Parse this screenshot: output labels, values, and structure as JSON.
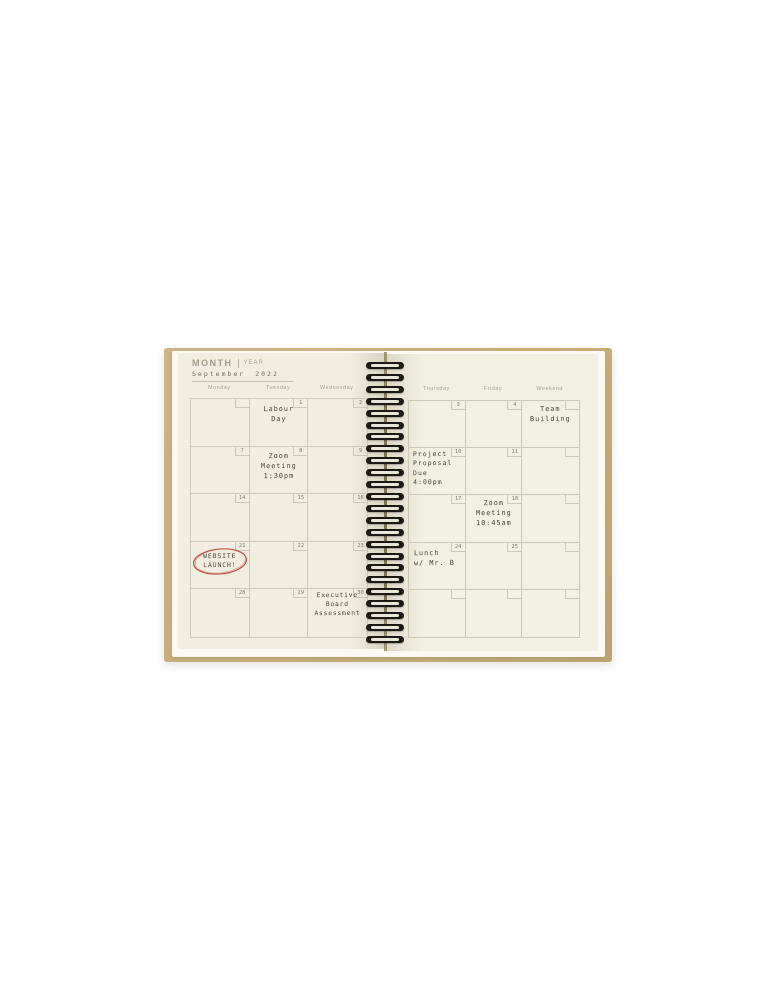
{
  "colors": {
    "annotation_red": "#c05548",
    "cover_kraft": "#c6ac79",
    "page_cream": "#f1eee1",
    "handwriting_ink": "#49443a"
  },
  "planner": {
    "header": {
      "month_label": "MONTH",
      "year_label": "YEAR",
      "month_value": "September",
      "year_value": "2022"
    },
    "left_page": {
      "day_headers": [
        "Monday",
        "Tuesday",
        "Wednesday"
      ],
      "rows": [
        {
          "cells": [
            {
              "date": "",
              "note": ""
            },
            {
              "date": "1",
              "note": "Labour\nDay"
            },
            {
              "date": "2",
              "note": ""
            }
          ]
        },
        {
          "cells": [
            {
              "date": "7",
              "note": ""
            },
            {
              "date": "8",
              "note": "Zoom\nMeeting\n1:30pm"
            },
            {
              "date": "9",
              "note": ""
            }
          ]
        },
        {
          "cells": [
            {
              "date": "14",
              "note": ""
            },
            {
              "date": "15",
              "note": ""
            },
            {
              "date": "16",
              "note": ""
            }
          ]
        },
        {
          "cells": [
            {
              "date": "21",
              "note": "WEBSITE\nLAUNCH!",
              "annotation": "red hand-drawn circle"
            },
            {
              "date": "22",
              "note": ""
            },
            {
              "date": "23",
              "note": ""
            }
          ]
        },
        {
          "cells": [
            {
              "date": "28",
              "note": ""
            },
            {
              "date": "29",
              "note": ""
            },
            {
              "date": "30",
              "note": "Executive\nBoard\nAssessment"
            }
          ]
        }
      ]
    },
    "right_page": {
      "day_headers": [
        "Thursday",
        "Friday",
        "Weekend"
      ],
      "rows": [
        {
          "cells": [
            {
              "date": "3",
              "note": ""
            },
            {
              "date": "4",
              "note": ""
            },
            {
              "date": "",
              "note": "Team\nBuilding"
            }
          ]
        },
        {
          "cells": [
            {
              "date": "10",
              "note": "Project\nProposal\nDue\n4:00pm"
            },
            {
              "date": "11",
              "note": ""
            },
            {
              "date": "",
              "note": ""
            }
          ]
        },
        {
          "cells": [
            {
              "date": "17",
              "note": ""
            },
            {
              "date": "18",
              "note": "Zoom\nMeeting\n10:45am"
            },
            {
              "date": "",
              "note": ""
            }
          ]
        },
        {
          "cells": [
            {
              "date": "24",
              "note": "Lunch\nw/ Mr. B"
            },
            {
              "date": "25",
              "note": ""
            },
            {
              "date": "",
              "note": ""
            }
          ]
        },
        {
          "cells": [
            {
              "date": "",
              "note": ""
            },
            {
              "date": "",
              "note": ""
            },
            {
              "date": "",
              "note": ""
            }
          ]
        }
      ]
    }
  }
}
